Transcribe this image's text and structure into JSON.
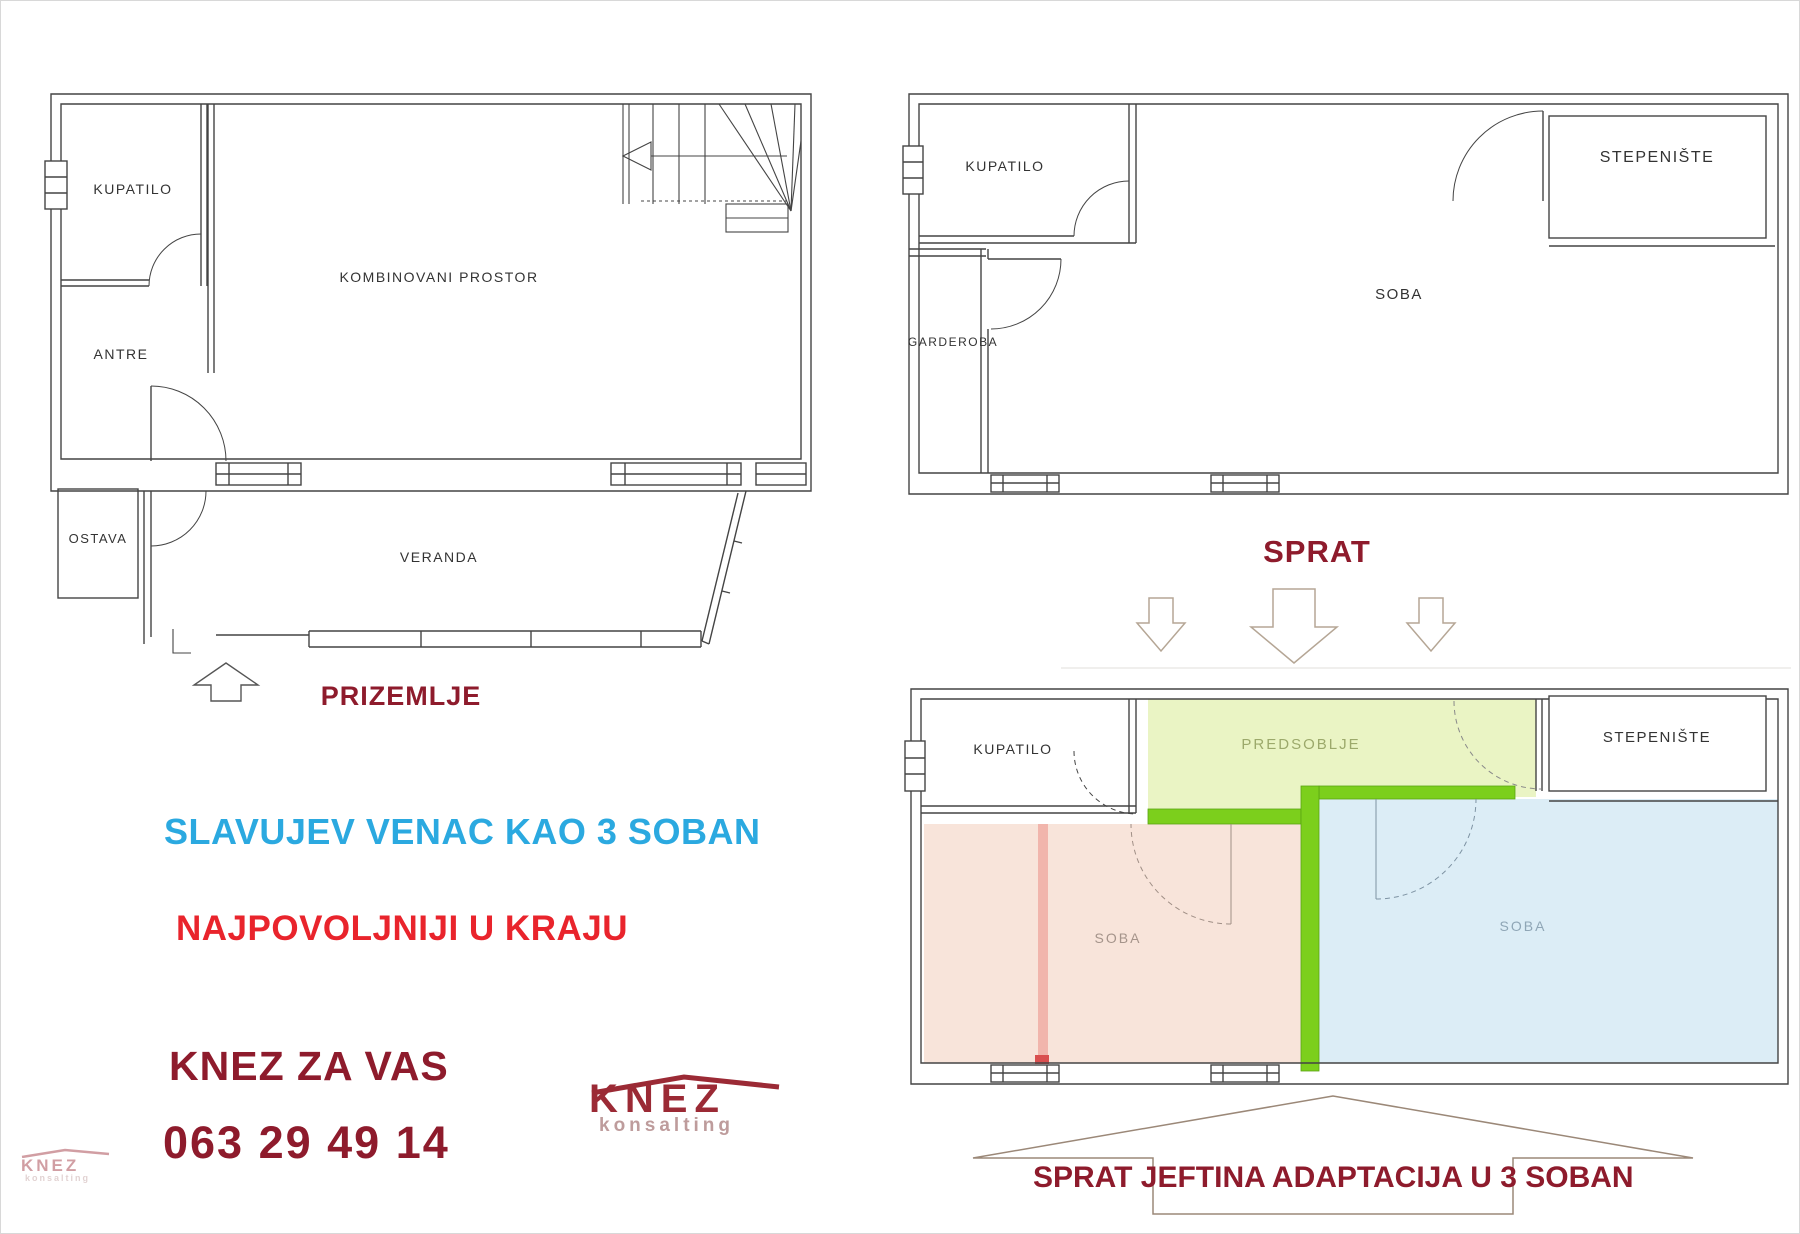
{
  "plans": {
    "ground": {
      "caption": "PRIZEMLJE",
      "rooms": {
        "kupatilo": "KUPATILO",
        "antre": "ANTRE",
        "kombinovani": "KOMBINOVANI PROSTOR",
        "ostava": "OSTAVA",
        "veranda": "VERANDA"
      }
    },
    "upper": {
      "caption": "SPRAT",
      "rooms": {
        "kupatilo": "KUPATILO",
        "garderoba": "GARDEROBA",
        "soba": "SOBA",
        "stepeniste": "STEPENIŠTE"
      }
    },
    "adapted": {
      "caption": "SPRAT  JEFTINA ADAPTACIJA U 3 SOBAN",
      "rooms": {
        "kupatilo": "KUPATILO",
        "predsoblje": "PREDSOBLJE",
        "soba_left": "SOBA",
        "soba_right": "SOBA",
        "stepeniste": "STEPENIŠTE"
      }
    }
  },
  "marketing": {
    "line1": "SLAVUJEV VENAC  KAO 3 SOBAN",
    "line2": "NAJPOVOLJNIJI U KRAJU",
    "line3": "KNEZ  ZA VAS",
    "phone": "063  29 49 14"
  },
  "logo": {
    "name": "KNEZ",
    "sub": "konsalting"
  },
  "watermark": {
    "name": "KNEZ",
    "sub": "konsalting"
  },
  "colors": {
    "caption_maroon": "#8E1B2C",
    "marketing_blue": "#2BA9E0",
    "marketing_red": "#E9242C",
    "logo_maroon": "#9B2A35",
    "new_wall_green": "#7CCF1C",
    "predsoblje_fill": "#EAF4C4",
    "soba_left_fill": "#F8E4DA",
    "soba_right_fill": "#DCEDF6",
    "removed_wall_pink": "#F1B5AC",
    "plan_line": "#444444"
  }
}
